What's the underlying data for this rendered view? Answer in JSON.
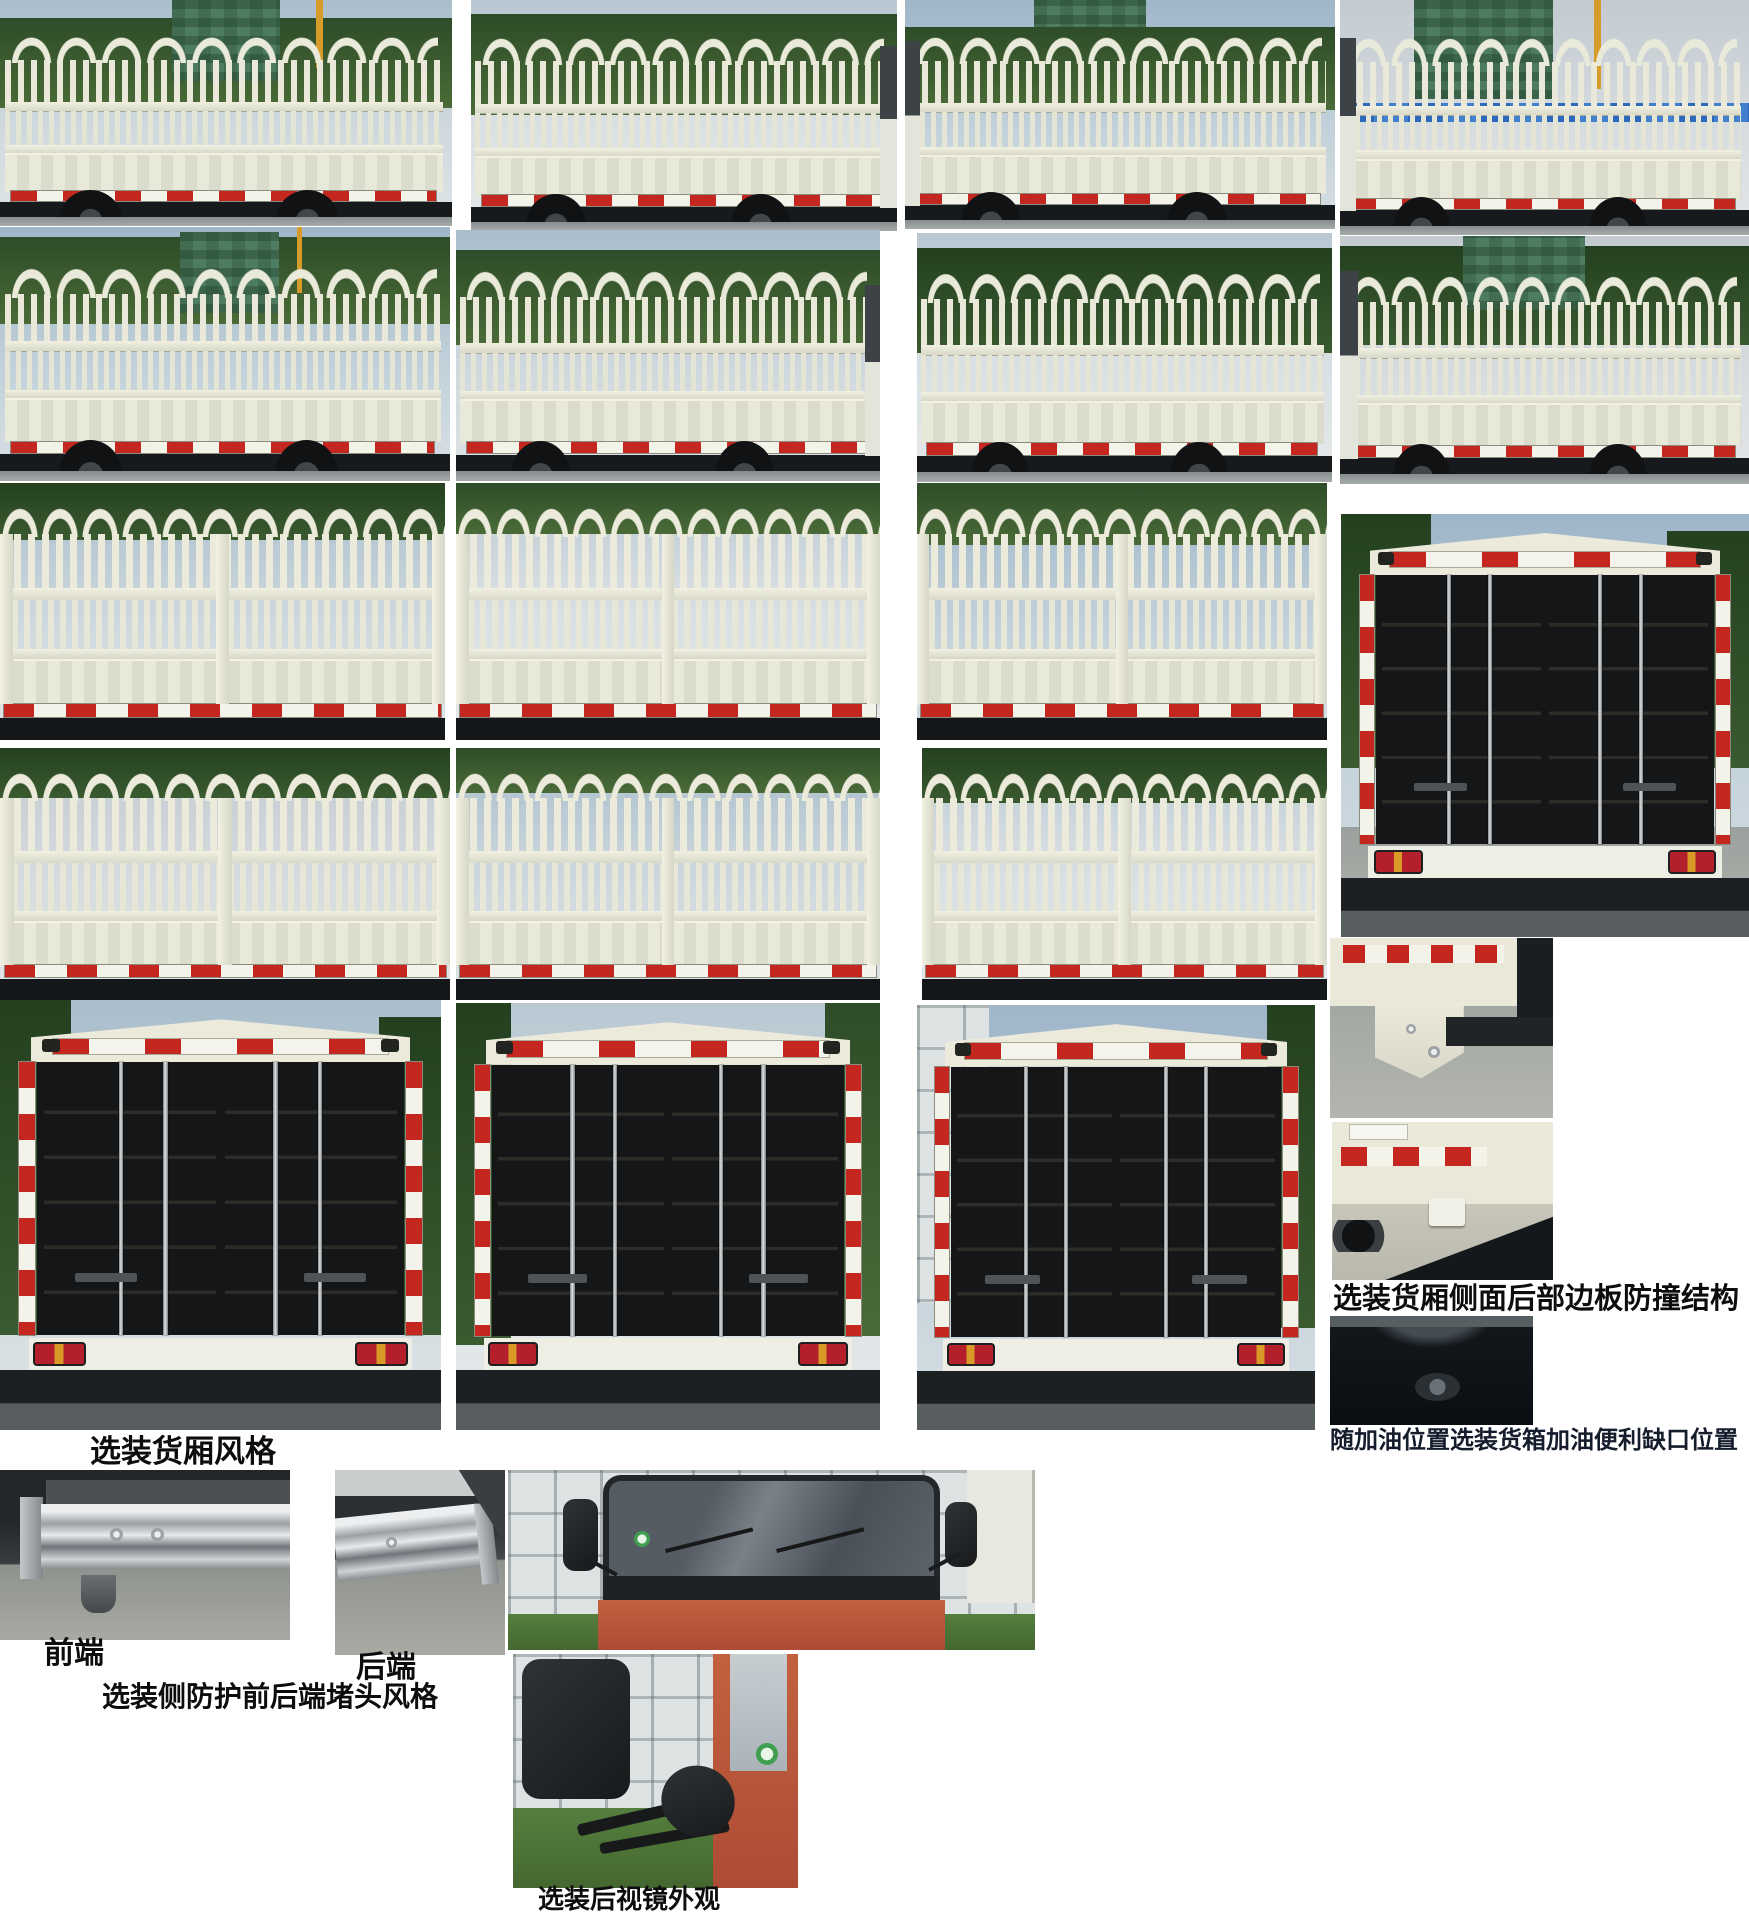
{
  "captions": {
    "cargo_box_style": "选装货厢风格",
    "side_rear_edge_anticollision": "选装货厢侧面后部边板防撞结构",
    "fuel_notch": "随加油位置选装货箱加油便利缺口位置",
    "front_end": "前端",
    "rear_end": "后端",
    "side_guard_plug_style": "选装侧防护前后端堵头风格",
    "mirror_appearance": "选装后视镜外观"
  },
  "colors": {
    "page_background": "#FFFFFF",
    "caption_text": "#0D0D10",
    "truck_body_cream": "#E9EAD9",
    "reflective_red": "#C3271F",
    "reflective_white": "#F3F3EA",
    "cab_red_orange": "#B5543C",
    "chassis_black": "#171A1C",
    "tree_green": "#3A5A30",
    "construction_mesh_green": "#4D7C60",
    "crane_yellow": "#D79B2A",
    "fence_blue": "#2D68BD"
  },
  "photos": [
    {
      "name": "stake-truck-side-1",
      "subject": "stake truck side view"
    },
    {
      "name": "stake-truck-side-2",
      "subject": "stake truck side view"
    },
    {
      "name": "stake-truck-side-3",
      "subject": "stake truck side view"
    },
    {
      "name": "stake-truck-side-4",
      "subject": "stake truck side view"
    },
    {
      "name": "stake-truck-side-5",
      "subject": "stake truck side view"
    },
    {
      "name": "stake-truck-side-6",
      "subject": "stake truck side view"
    },
    {
      "name": "stake-truck-side-7",
      "subject": "stake truck side view"
    },
    {
      "name": "stake-truck-side-8",
      "subject": "stake truck side view"
    },
    {
      "name": "stake-body-rear-quarter-1",
      "subject": "stake cargo body close view"
    },
    {
      "name": "stake-body-rear-quarter-2",
      "subject": "stake cargo body close view"
    },
    {
      "name": "stake-body-rear-quarter-3",
      "subject": "stake cargo body close view"
    },
    {
      "name": "truck-rear-view-tall",
      "subject": "truck rear doors full view"
    },
    {
      "name": "stake-body-rear-quarter-4",
      "subject": "stake cargo body close view"
    },
    {
      "name": "stake-body-rear-quarter-5",
      "subject": "stake cargo body close view"
    },
    {
      "name": "stake-body-rear-quarter-6",
      "subject": "stake cargo body close view"
    },
    {
      "name": "rear-doors-view-1",
      "subject": "cargo box rear doors"
    },
    {
      "name": "rear-doors-view-2",
      "subject": "cargo box rear doors"
    },
    {
      "name": "rear-doors-view-3",
      "subject": "cargo box rear doors"
    },
    {
      "name": "anticollision-detail-top",
      "subject": "rear corner bracket detail"
    },
    {
      "name": "anticollision-detail-bottom",
      "subject": "rear edge board hook detail"
    },
    {
      "name": "fuel-notch-detail",
      "subject": "dark underside notch detail"
    },
    {
      "name": "side-guard-front-end-detail",
      "subject": "guardrail front end cap"
    },
    {
      "name": "side-guard-rear-end-detail",
      "subject": "guardrail rear end cap"
    },
    {
      "name": "cab-front-view",
      "subject": "cab front with mirrors"
    },
    {
      "name": "mirror-closeup",
      "subject": "rearview mirror close-up"
    }
  ]
}
